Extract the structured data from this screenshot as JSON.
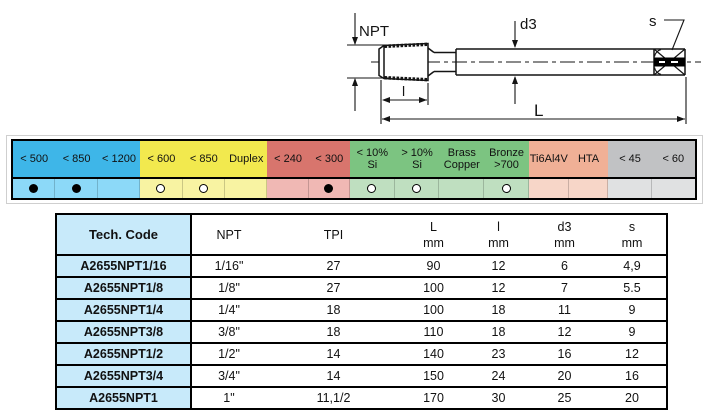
{
  "diagram": {
    "labels": {
      "npt": "NPT",
      "d3": "d3",
      "s": "s",
      "len_thread": "l",
      "len_total": "L"
    }
  },
  "materials_table": {
    "groups": [
      {
        "name": "steel-blue",
        "header_color": "#3EB6E8",
        "dots_color": "#8CD9F8",
        "cols": [
          {
            "label_lines": [
              "< 500"
            ],
            "mark": "filled"
          },
          {
            "label_lines": [
              "< 850"
            ],
            "mark": "filled"
          },
          {
            "label_lines": [
              "< 1200"
            ],
            "mark": "none"
          }
        ]
      },
      {
        "name": "stainless-yellow",
        "header_color": "#F2E94E",
        "dots_color": "#F8F3A2",
        "cols": [
          {
            "label_lines": [
              "< 600"
            ],
            "mark": "open"
          },
          {
            "label_lines": [
              "< 850"
            ],
            "mark": "open"
          },
          {
            "label_lines": [
              "Duplex"
            ],
            "mark": "none"
          }
        ]
      },
      {
        "name": "cast-iron-red",
        "header_color": "#D8756D",
        "dots_color": "#F0B8B4",
        "cols": [
          {
            "label_lines": [
              "< 240"
            ],
            "mark": "none"
          },
          {
            "label_lines": [
              "< 300"
            ],
            "mark": "filled"
          }
        ]
      },
      {
        "name": "non-ferrous-green",
        "header_color": "#7CC481",
        "dots_color": "#BFDFC0",
        "cols": [
          {
            "label_lines": [
              "< 10%",
              "Si"
            ],
            "mark": "open"
          },
          {
            "label_lines": [
              "> 10%",
              "Si"
            ],
            "mark": "open"
          },
          {
            "label_lines": [
              "Brass",
              "Copper"
            ],
            "mark": "none"
          },
          {
            "label_lines": [
              "Bronze",
              ">700"
            ],
            "mark": "open"
          }
        ]
      },
      {
        "name": "titanium-pink",
        "header_color": "#F0B096",
        "dots_color": "#F7D6C8",
        "cols": [
          {
            "label_lines": [
              "Ti6Al4V"
            ],
            "mark": "none"
          },
          {
            "label_lines": [
              "HTA"
            ],
            "mark": "none"
          }
        ]
      },
      {
        "name": "hardened-gray",
        "header_color": "#C1C2C4",
        "dots_color": "#E0E1E2",
        "cols": [
          {
            "label_lines": [
              "< 45"
            ],
            "mark": "none"
          },
          {
            "label_lines": [
              "< 60"
            ],
            "mark": "none"
          }
        ]
      }
    ]
  },
  "spec_table": {
    "headers": [
      {
        "top": "Tech. Code",
        "bottom": ""
      },
      {
        "top": "NPT",
        "bottom": ""
      },
      {
        "top": "TPI",
        "bottom": ""
      },
      {
        "top": "L",
        "bottom": "mm"
      },
      {
        "top": "l",
        "bottom": "mm"
      },
      {
        "top": "d3",
        "bottom": "mm"
      },
      {
        "top": "s",
        "bottom": "mm"
      }
    ],
    "rows": [
      [
        "A2655NPT1/16",
        "1/16\"",
        "27",
        "90",
        "12",
        "6",
        "4,9"
      ],
      [
        "A2655NPT1/8",
        "1/8\"",
        "27",
        "100",
        "12",
        "7",
        "5.5"
      ],
      [
        "A2655NPT1/4",
        "1/4\"",
        "18",
        "100",
        "18",
        "11",
        "9"
      ],
      [
        "A2655NPT3/8",
        "3/8\"",
        "18",
        "110",
        "18",
        "12",
        "9"
      ],
      [
        "A2655NPT1/2",
        "1/2\"",
        "14",
        "140",
        "23",
        "16",
        "12"
      ],
      [
        "A2655NPT3/4",
        "3/4\"",
        "14",
        "150",
        "24",
        "20",
        "16"
      ],
      [
        "A2655NPT1",
        "1\"",
        "11,1/2",
        "170",
        "30",
        "25",
        "20"
      ]
    ]
  }
}
